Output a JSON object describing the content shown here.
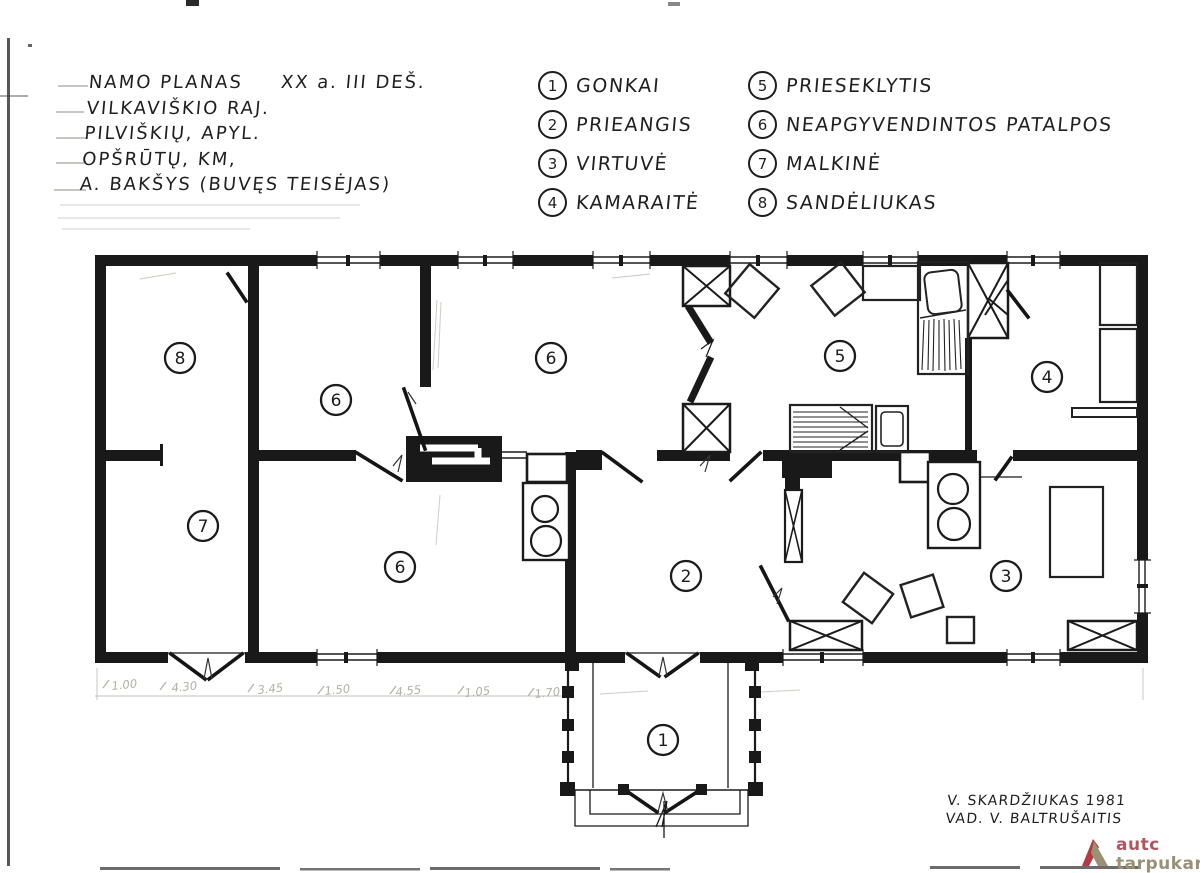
{
  "header": {
    "title": "NAMO PLANAS",
    "era": "XX a. III DEŠ.",
    "line2": "VILKAVIŠKIO RAJ.",
    "line3": "PILVIŠKIŲ, APYL.",
    "line4": "OPŠRŪTŲ, KM,",
    "line5": "A. BAKŠYS (BUVĘS TEISĖJAS)"
  },
  "legend": {
    "items": [
      {
        "num": "1",
        "label": "GONKAI"
      },
      {
        "num": "2",
        "label": "PRIEANGIS"
      },
      {
        "num": "3",
        "label": "VIRTUVĖ"
      },
      {
        "num": "4",
        "label": "KAMARAITĖ"
      },
      {
        "num": "5",
        "label": "PRIESEKLYTIS"
      },
      {
        "num": "6",
        "label": "NEAPGYVENDINTOS PATALPOS"
      },
      {
        "num": "7",
        "label": "MALKINĖ"
      },
      {
        "num": "8",
        "label": "SANDĖLIUKAS"
      }
    ]
  },
  "plan": {
    "rooms": [
      {
        "number": "8",
        "name": "SANDĖLIUKAS"
      },
      {
        "number": "6",
        "name": "NEAPGYVENDINTOS PATALPOS"
      },
      {
        "number": "6",
        "name": "NEAPGYVENDINTOS PATALPOS"
      },
      {
        "number": "5",
        "name": "PRIESEKLYTIS"
      },
      {
        "number": "4",
        "name": "KAMARAITĖ"
      },
      {
        "number": "7",
        "name": "MALKINĖ"
      },
      {
        "number": "6",
        "name": "NEAPGYVENDINTOS PATALPOS"
      },
      {
        "number": "2",
        "name": "PRIEANGIS"
      },
      {
        "number": "3",
        "name": "VIRTUVĖ"
      },
      {
        "number": "1",
        "name": "GONKAI"
      }
    ],
    "dimensions": [
      "1.00",
      "4.30",
      "3.45",
      "1.50",
      "4.55",
      "1.05",
      "1.70"
    ]
  },
  "signature": {
    "line1": "V. SKARDŽIUKAS  1981",
    "line2": "VAD. V. BALTRUŠAITIS"
  },
  "logo": {
    "line1": "autc",
    "line2": "tarpukaris"
  },
  "colors": {
    "ink": "#1b1b1b",
    "paper": "#ffffff",
    "pencil": "#b7b3ab",
    "logo_red": "#b23b43",
    "logo_olive": "#9a9175",
    "logo_text_red": "#b4555b"
  }
}
